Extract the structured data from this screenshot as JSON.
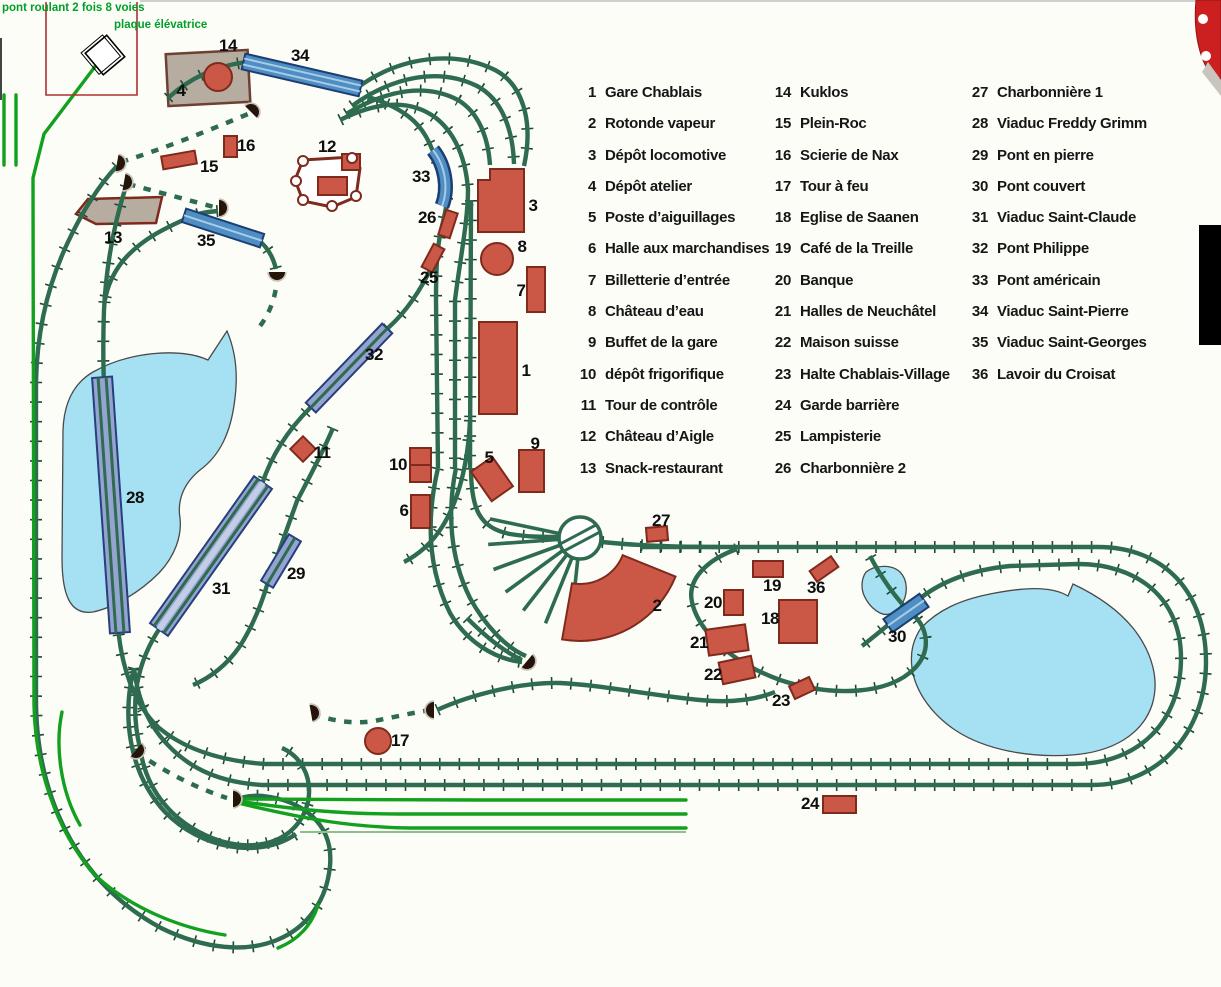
{
  "annotations": {
    "line1": "pont roulant 2 fois 8 voies",
    "line2": "plaque élévatrice"
  },
  "legend": {
    "columns": [
      {
        "items": [
          {
            "num": "1",
            "label": "Gare Chablais"
          },
          {
            "num": "2",
            "label": "Rotonde vapeur"
          },
          {
            "num": "3",
            "label": "Dépôt locomotive"
          },
          {
            "num": "4",
            "label": "Dépôt atelier"
          },
          {
            "num": "5",
            "label": "Poste d’aiguillages"
          },
          {
            "num": "6",
            "label": "Halle aux marchandises"
          },
          {
            "num": "7",
            "label": "Billetterie d’entrée"
          },
          {
            "num": "8",
            "label": "Château d’eau"
          },
          {
            "num": "9",
            "label": "Buffet de la gare"
          },
          {
            "num": "10",
            "label": "dépôt frigorifique"
          },
          {
            "num": "11",
            "label": "Tour de contrôle"
          },
          {
            "num": "12",
            "label": "Château d’Aigle"
          },
          {
            "num": "13",
            "label": "Snack-restaurant"
          }
        ]
      },
      {
        "items": [
          {
            "num": "14",
            "label": "Kuklos"
          },
          {
            "num": "15",
            "label": "Plein-Roc"
          },
          {
            "num": "16",
            "label": "Scierie de Nax"
          },
          {
            "num": "17",
            "label": "Tour à feu"
          },
          {
            "num": "18",
            "label": "Eglise de Saanen"
          },
          {
            "num": "19",
            "label": "Café de la Treille"
          },
          {
            "num": "20",
            "label": "Banque"
          },
          {
            "num": "21",
            "label": "Halles de Neuchâtel"
          },
          {
            "num": "22",
            "label": "Maison suisse"
          },
          {
            "num": "23",
            "label": "Halte Chablais-Village"
          },
          {
            "num": "24",
            "label": "Garde barrière"
          },
          {
            "num": "25",
            "label": "Lampisterie"
          },
          {
            "num": "26",
            "label": "Charbonnière 2"
          }
        ]
      },
      {
        "items": [
          {
            "num": "27",
            "label": "Charbonnière 1"
          },
          {
            "num": "28",
            "label": "Viaduc Freddy Grimm"
          },
          {
            "num": "29",
            "label": "Pont en pierre"
          },
          {
            "num": "30",
            "label": "Pont couvert"
          },
          {
            "num": "31",
            "label": "Viaduc Saint-Claude"
          },
          {
            "num": "32",
            "label": "Pont Philippe"
          },
          {
            "num": "33",
            "label": "Pont américain"
          },
          {
            "num": "34",
            "label": "Viaduc Saint-Pierre"
          },
          {
            "num": "35",
            "label": "Viaduc Saint-Georges"
          },
          {
            "num": "36",
            "label": "Lavoir du Croisat"
          }
        ]
      }
    ]
  },
  "map": {
    "labels": [
      {
        "num": "14",
        "x": 228,
        "y": 46
      },
      {
        "num": "4",
        "x": 181,
        "y": 91
      },
      {
        "num": "34",
        "x": 300,
        "y": 56
      },
      {
        "num": "16",
        "x": 246,
        "y": 146
      },
      {
        "num": "15",
        "x": 209,
        "y": 167
      },
      {
        "num": "12",
        "x": 327,
        "y": 147
      },
      {
        "num": "33",
        "x": 421,
        "y": 177
      },
      {
        "num": "13",
        "x": 113,
        "y": 238
      },
      {
        "num": "35",
        "x": 206,
        "y": 241
      },
      {
        "num": "26",
        "x": 427,
        "y": 218
      },
      {
        "num": "25",
        "x": 429,
        "y": 278
      },
      {
        "num": "3",
        "x": 533,
        "y": 206
      },
      {
        "num": "8",
        "x": 522,
        "y": 247
      },
      {
        "num": "7",
        "x": 521,
        "y": 291
      },
      {
        "num": "1",
        "x": 526,
        "y": 371
      },
      {
        "num": "32",
        "x": 374,
        "y": 355
      },
      {
        "num": "9",
        "x": 535,
        "y": 444
      },
      {
        "num": "5",
        "x": 489,
        "y": 458
      },
      {
        "num": "10",
        "x": 398,
        "y": 465
      },
      {
        "num": "11",
        "x": 322,
        "y": 453
      },
      {
        "num": "6",
        "x": 404,
        "y": 511
      },
      {
        "num": "28",
        "x": 135,
        "y": 498
      },
      {
        "num": "29",
        "x": 296,
        "y": 574
      },
      {
        "num": "31",
        "x": 221,
        "y": 589
      },
      {
        "num": "27",
        "x": 661,
        "y": 521
      },
      {
        "num": "19",
        "x": 772,
        "y": 586
      },
      {
        "num": "36",
        "x": 816,
        "y": 588
      },
      {
        "num": "20",
        "x": 713,
        "y": 603
      },
      {
        "num": "18",
        "x": 770,
        "y": 619
      },
      {
        "num": "2",
        "x": 657,
        "y": 606
      },
      {
        "num": "21",
        "x": 699,
        "y": 643
      },
      {
        "num": "30",
        "x": 897,
        "y": 637
      },
      {
        "num": "22",
        "x": 713,
        "y": 675
      },
      {
        "num": "23",
        "x": 781,
        "y": 701
      },
      {
        "num": "17",
        "x": 400,
        "y": 741
      },
      {
        "num": "24",
        "x": 810,
        "y": 804
      }
    ]
  },
  "colors": {
    "track_green": "#2e6b4f",
    "tie_green": "#1d4a38",
    "hidden_yard_green": "#12a01e",
    "building_red": "#cb5846",
    "building_outline": "#7f2a1c",
    "bridge_blue": "#4e8ec2",
    "viaduct_lavender": "#95a3d1",
    "lake_blue": "#a5e0f3",
    "annotation_green": "#00a028",
    "grey_building": "#b7aca0",
    "black": "#000000"
  }
}
